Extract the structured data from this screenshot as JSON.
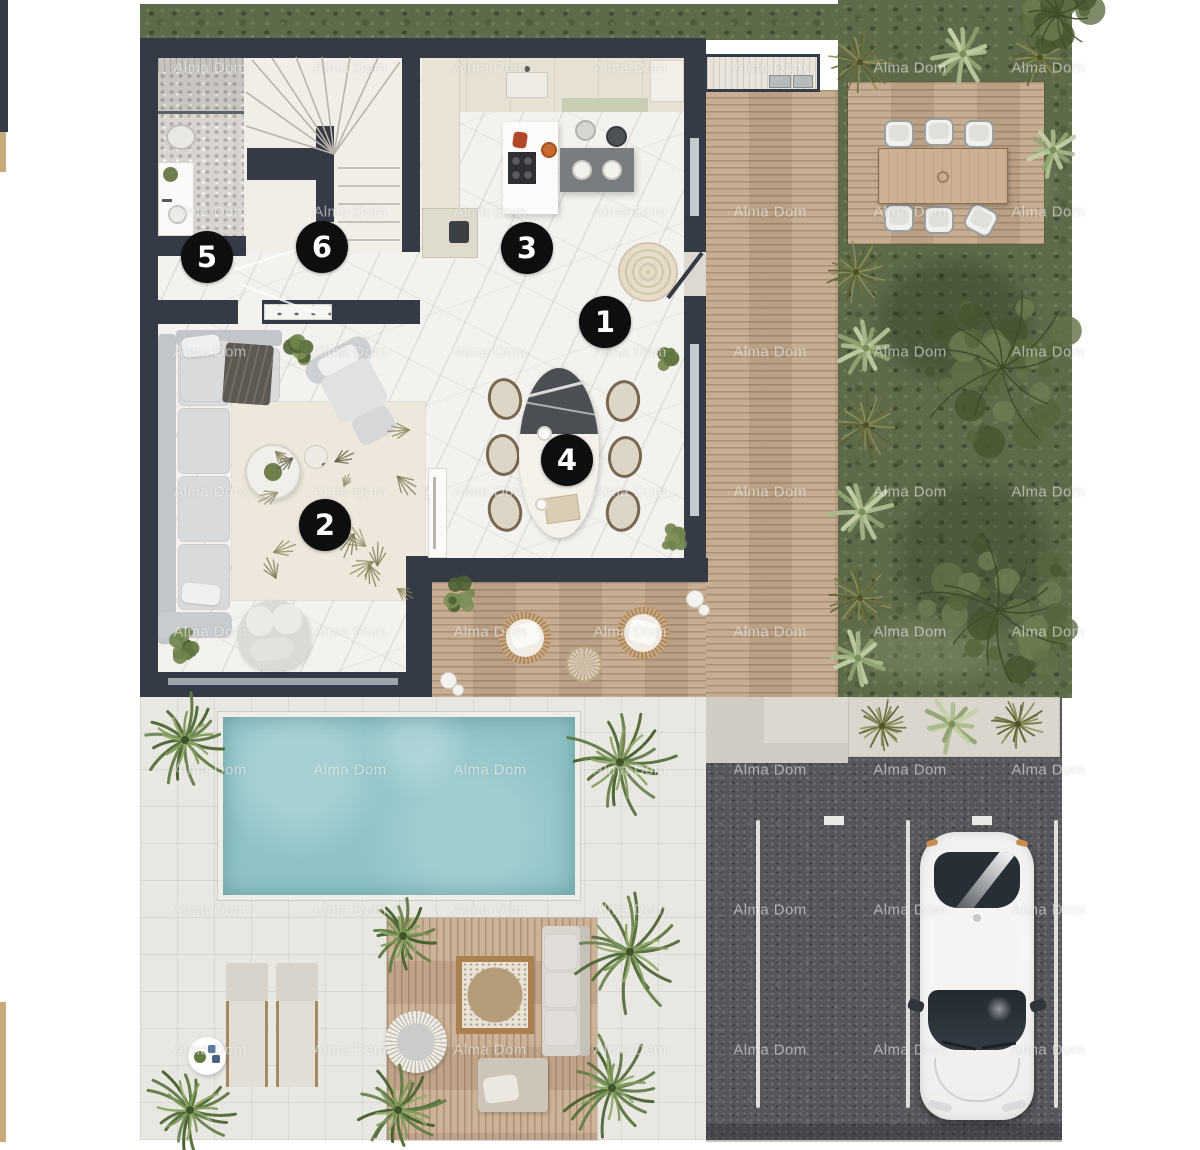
{
  "plan": {
    "kind_label": "floor-plan",
    "markers": [
      {
        "label": "1",
        "x": 605,
        "y": 322
      },
      {
        "label": "2",
        "x": 325,
        "y": 525
      },
      {
        "label": "3",
        "x": 527,
        "y": 248
      },
      {
        "label": "4",
        "x": 567,
        "y": 460
      },
      {
        "label": "5",
        "x": 207,
        "y": 257
      },
      {
        "label": "6",
        "x": 322,
        "y": 247
      }
    ],
    "watermark": {
      "text": "Alma Dom",
      "cols": [
        210,
        350,
        490,
        630,
        770,
        910,
        1048
      ],
      "rows": [
        68,
        212,
        352,
        492,
        632,
        770,
        910,
        1050
      ]
    },
    "colors": {
      "wall": "#343a46",
      "marble": "#f4f2ee",
      "pebble": "#d8d5d1",
      "wood": "#c4a98c",
      "grass": "#5e6b4b",
      "terrace": "#e9e7e2",
      "pool": "#8fc3c7",
      "asphalt": "#56575b",
      "marker_bg": "#0e0e0e",
      "marker_text": "#ffffff"
    }
  }
}
